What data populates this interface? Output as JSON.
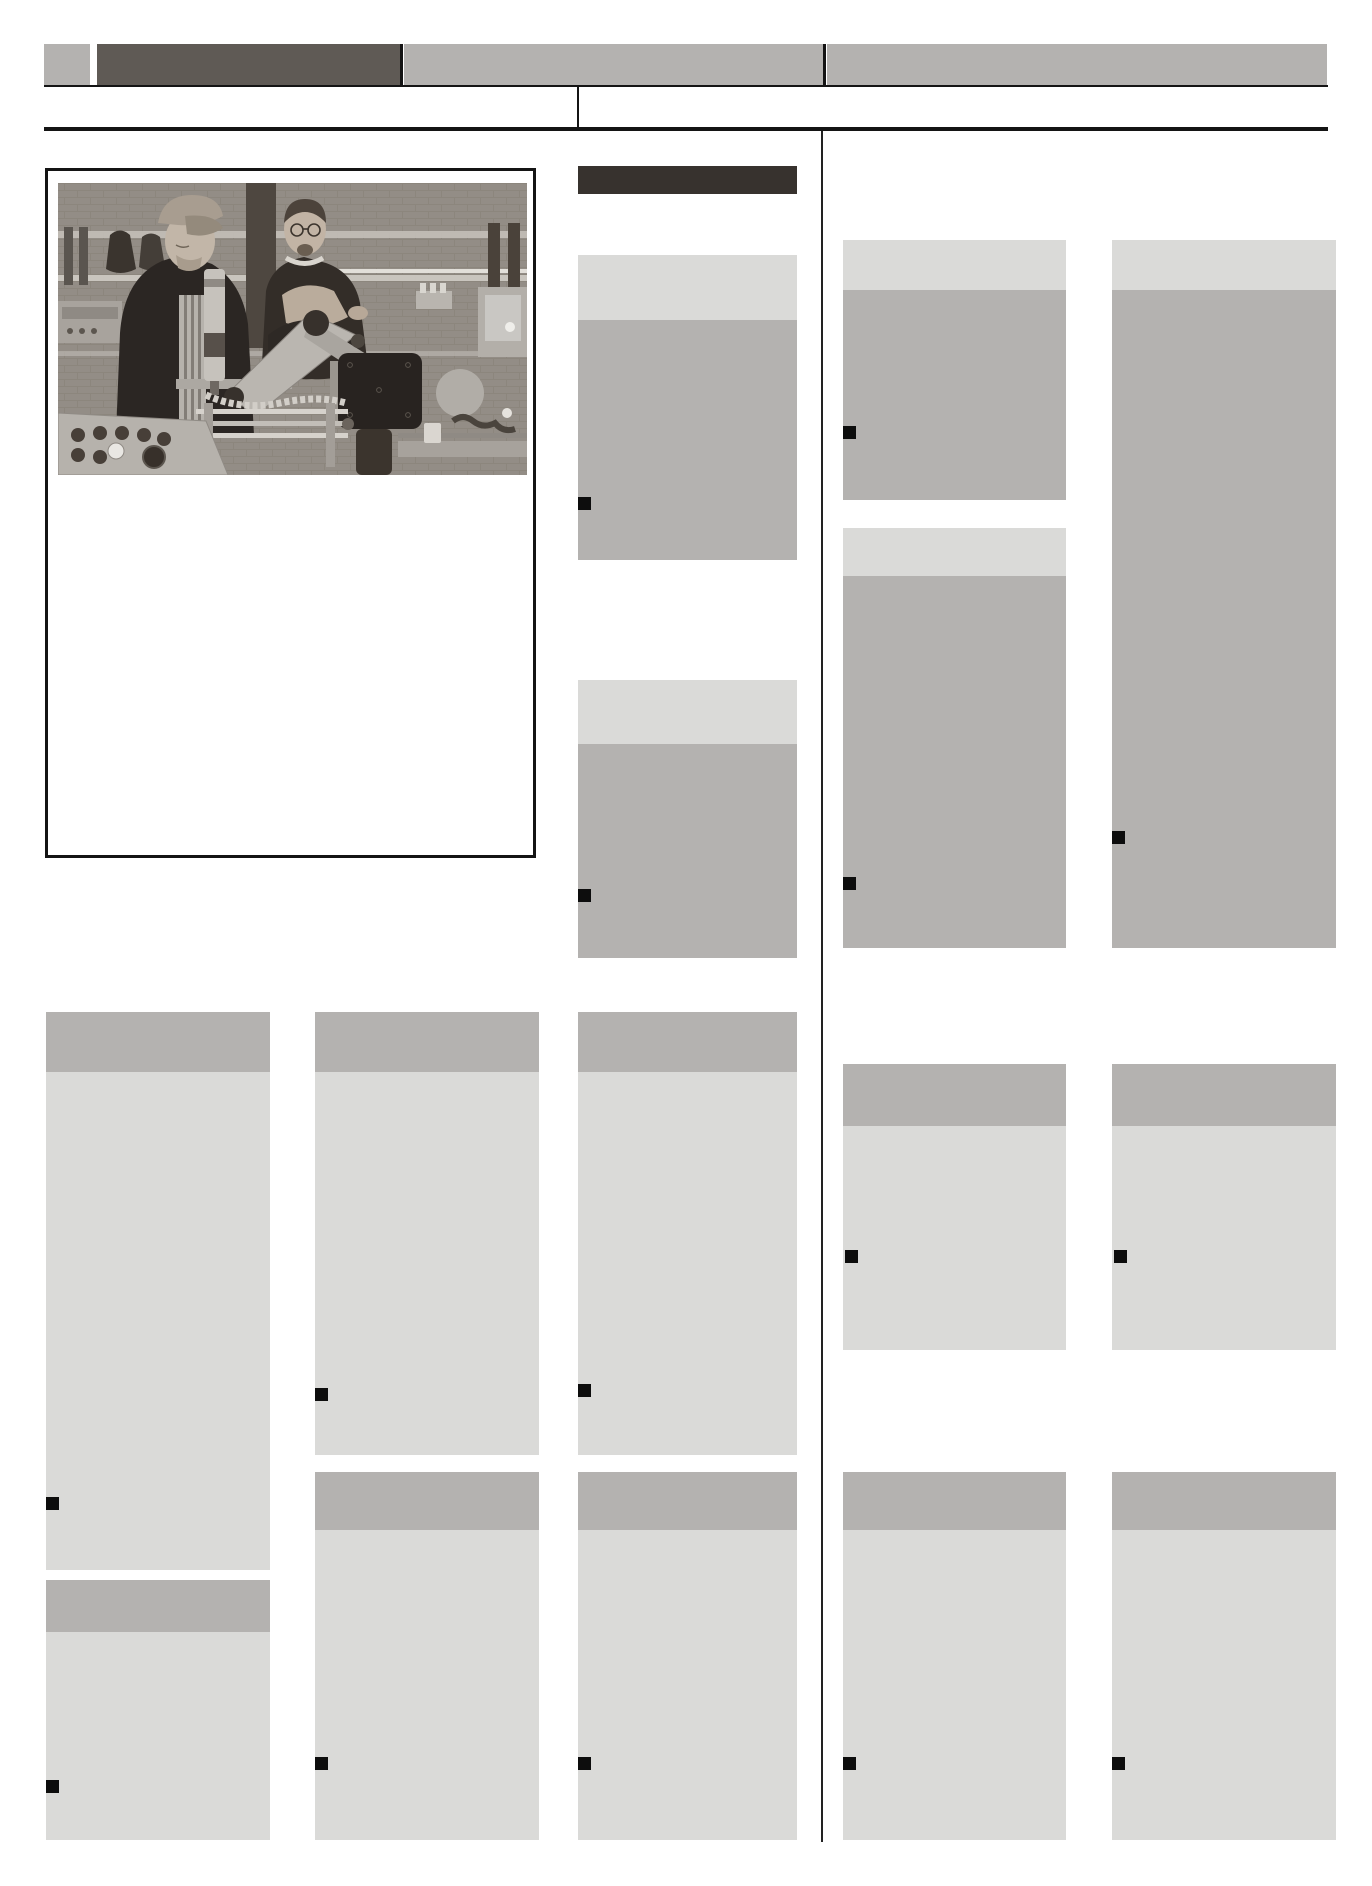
{
  "page": {
    "width": 1372,
    "height": 1886,
    "background": "#ffffff",
    "kind": "newspaper-front-page-template",
    "visible_text": "none (all content greeked as gray placeholder blocks)"
  },
  "colors": {
    "paper": "#ffffff",
    "gray_mid": "#b4b2b0",
    "gray_light": "#dadad8",
    "masthead_dark": "#5f5a55",
    "headline_dark": "#37322e",
    "rule": "#141414",
    "divider": "#222222",
    "marker": "#0d0d0d"
  },
  "masthead": {
    "blocks": [
      {
        "name": "nameplate-square",
        "x": 44,
        "y": 44,
        "w": 46,
        "h": 42,
        "color": "gray_mid"
      },
      {
        "name": "nameplate-dark",
        "x": 97,
        "y": 44,
        "w": 303,
        "h": 42,
        "color": "masthead_dark"
      },
      {
        "name": "nameplate-gray-1",
        "x": 404,
        "y": 44,
        "w": 420,
        "h": 42,
        "color": "gray_mid"
      },
      {
        "name": "nameplate-gray-2",
        "x": 827,
        "y": 44,
        "w": 500,
        "h": 42,
        "color": "gray_mid"
      }
    ],
    "separators": [
      {
        "name": "nameplate-separator-1",
        "x": 400,
        "y": 44,
        "w": 3,
        "h": 42
      },
      {
        "name": "nameplate-separator-2",
        "x": 823,
        "y": 44,
        "w": 3,
        "h": 42
      }
    ]
  },
  "rules": [
    {
      "name": "masthead-rule-thin",
      "x": 44,
      "y": 85,
      "w": 1284,
      "h": 2
    },
    {
      "name": "dateline-tick",
      "x": 577,
      "y": 87,
      "w": 2,
      "h": 40
    },
    {
      "name": "masthead-rule-thick",
      "x": 44,
      "y": 127,
      "w": 1284,
      "h": 4
    },
    {
      "name": "column-divider",
      "x": 821,
      "y": 131,
      "w": 2,
      "h": 1711
    }
  ],
  "headline_bar": {
    "name": "section-headline-bar",
    "x": 578,
    "y": 166,
    "w": 219,
    "h": 28,
    "color": "headline_dark"
  },
  "photo_box": {
    "x": 45,
    "y": 168,
    "w": 491,
    "h": 690,
    "photo": {
      "x": 10,
      "y": 12,
      "w": 469,
      "h": 292,
      "subject": "two-men-inspecting-assembly-machine-in-workshop"
    },
    "caption_area": "blank"
  },
  "marker_size": 13,
  "articles": [
    {
      "name": "middle-top",
      "style": "light-top",
      "x": 578,
      "w": 219,
      "header_y": 255,
      "header_h": 65,
      "body_y": 320,
      "body_h": 240,
      "marker_x": 578,
      "marker_y": 497
    },
    {
      "name": "middle-second",
      "style": "light-top",
      "x": 578,
      "w": 219,
      "header_y": 680,
      "header_h": 64,
      "body_y": 744,
      "body_h": 214,
      "marker_x": 578,
      "marker_y": 889
    },
    {
      "name": "right-col1-top",
      "style": "light-top",
      "x": 843,
      "w": 223,
      "header_y": 240,
      "header_h": 50,
      "body_y": 290,
      "body_h": 210,
      "marker_x": 843,
      "marker_y": 426
    },
    {
      "name": "right-col1-second",
      "style": "light-top",
      "x": 843,
      "w": 223,
      "header_y": 528,
      "header_h": 48,
      "body_y": 576,
      "body_h": 372,
      "marker_x": 843,
      "marker_y": 877
    },
    {
      "name": "right-col2-tall",
      "style": "light-top",
      "x": 1112,
      "w": 224,
      "header_y": 240,
      "header_h": 50,
      "body_y": 290,
      "body_h": 658,
      "marker_x": 1112,
      "marker_y": 831
    },
    {
      "name": "left-col1-main",
      "style": "kicker",
      "x": 46,
      "w": 224,
      "header_y": 1012,
      "header_h": 60,
      "body_y": 1072,
      "body_h": 498,
      "marker_x": 46,
      "marker_y": 1497
    },
    {
      "name": "left-col2-main",
      "style": "kicker",
      "x": 315,
      "w": 224,
      "header_y": 1012,
      "header_h": 60,
      "body_y": 1072,
      "body_h": 383,
      "marker_x": 315,
      "marker_y": 1388
    },
    {
      "name": "left-col3-main",
      "style": "kicker",
      "x": 578,
      "w": 219,
      "header_y": 1012,
      "header_h": 60,
      "body_y": 1072,
      "body_h": 383,
      "marker_x": 578,
      "marker_y": 1384
    },
    {
      "name": "right-col1-middle",
      "style": "kicker",
      "x": 843,
      "w": 223,
      "header_y": 1064,
      "header_h": 62,
      "body_y": 1126,
      "body_h": 224,
      "marker_x": 845,
      "marker_y": 1250
    },
    {
      "name": "right-col2-middle",
      "style": "kicker",
      "x": 1112,
      "w": 224,
      "header_y": 1064,
      "header_h": 62,
      "body_y": 1126,
      "body_h": 224,
      "marker_x": 1114,
      "marker_y": 1250
    },
    {
      "name": "left-col1-bottom",
      "style": "kicker",
      "x": 46,
      "w": 224,
      "header_y": 1580,
      "header_h": 52,
      "body_y": 1632,
      "body_h": 208,
      "marker_x": 46,
      "marker_y": 1780
    },
    {
      "name": "left-col2-bottom",
      "style": "kicker",
      "x": 315,
      "w": 224,
      "header_y": 1472,
      "header_h": 58,
      "body_y": 1530,
      "body_h": 310,
      "marker_x": 315,
      "marker_y": 1757
    },
    {
      "name": "left-col3-bottom",
      "style": "kicker",
      "x": 578,
      "w": 219,
      "header_y": 1472,
      "header_h": 58,
      "body_y": 1530,
      "body_h": 310,
      "marker_x": 578,
      "marker_y": 1757
    },
    {
      "name": "right-col1-bottom",
      "style": "kicker",
      "x": 843,
      "w": 223,
      "header_y": 1472,
      "header_h": 58,
      "body_y": 1530,
      "body_h": 310,
      "marker_x": 843,
      "marker_y": 1757
    },
    {
      "name": "right-col2-bottom",
      "style": "kicker",
      "x": 1112,
      "w": 224,
      "header_y": 1472,
      "header_h": 58,
      "body_y": 1530,
      "body_h": 310,
      "marker_x": 1112,
      "marker_y": 1757
    }
  ]
}
